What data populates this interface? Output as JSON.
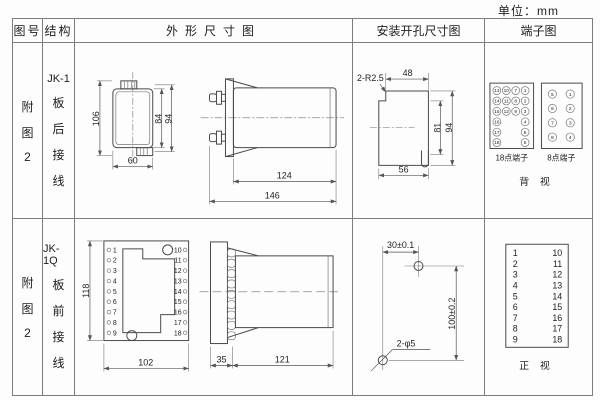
{
  "unit_label": "单位：mm",
  "header": {
    "figure_col": "图号",
    "structure_col": "结构",
    "outline_col": "外形尺寸图",
    "mounting_col": "安装开孔尺寸图",
    "terminal_col": "端子图"
  },
  "row1": {
    "figure": {
      "c1": "附",
      "c2": "图",
      "c3": "2"
    },
    "structure": {
      "model": "JK-1",
      "c1": "板",
      "c2": "后",
      "c3": "接",
      "c4": "线"
    },
    "outline": {
      "dim_height_total": "106",
      "dim_height_inner": "84",
      "dim_height_outer": "94",
      "dim_width": "60",
      "dim_depth_body": "124",
      "dim_depth_total": "146"
    },
    "mounting": {
      "dim_corner_radius": "2-R2.5",
      "dim_top_width": "48",
      "dim_inner_height": "81",
      "dim_height": "94",
      "dim_bottom_width": "56"
    },
    "terminal": {
      "label_18": "18点端子",
      "label_8": "8点端子",
      "view_label": "背 视",
      "grid18": {
        "c1": [
          "13",
          "14",
          "15",
          "16",
          "17",
          "18"
        ],
        "c2": [
          "10",
          "11",
          "12"
        ],
        "c3": [
          "7",
          "8",
          "9"
        ],
        "c4": [
          "1",
          "2",
          "3",
          "4",
          "5",
          "6"
        ]
      },
      "grid8": {
        "left": [
          "5",
          "6",
          "7",
          "8"
        ],
        "right": [
          "1",
          "2",
          "3",
          "4"
        ]
      }
    }
  },
  "row2": {
    "figure": {
      "c1": "附",
      "c2": "图",
      "c3": "2"
    },
    "structure": {
      "model": "JK-1Q",
      "c1": "板",
      "c2": "前",
      "c3": "接",
      "c4": "线"
    },
    "outline": {
      "dim_height": "118",
      "dim_width": "102",
      "dim_flange_depth": "35",
      "dim_body_depth": "121",
      "left_terminals": [
        "1",
        "2",
        "3",
        "4",
        "5",
        "6",
        "7",
        "8",
        "9"
      ],
      "right_terminals": [
        "10",
        "11",
        "12",
        "13",
        "14",
        "15",
        "16",
        "17",
        "18"
      ]
    },
    "mounting": {
      "dim_h_spacing": "30±0.1",
      "dim_v_spacing": "100±0.2",
      "dim_hole": "2-φ5"
    },
    "terminal": {
      "left": [
        "1",
        "2",
        "3",
        "4",
        "5",
        "6",
        "7",
        "8",
        "9"
      ],
      "right": [
        "10",
        "11",
        "12",
        "13",
        "14",
        "15",
        "16",
        "17",
        "18"
      ],
      "view_label": "正 视"
    }
  }
}
